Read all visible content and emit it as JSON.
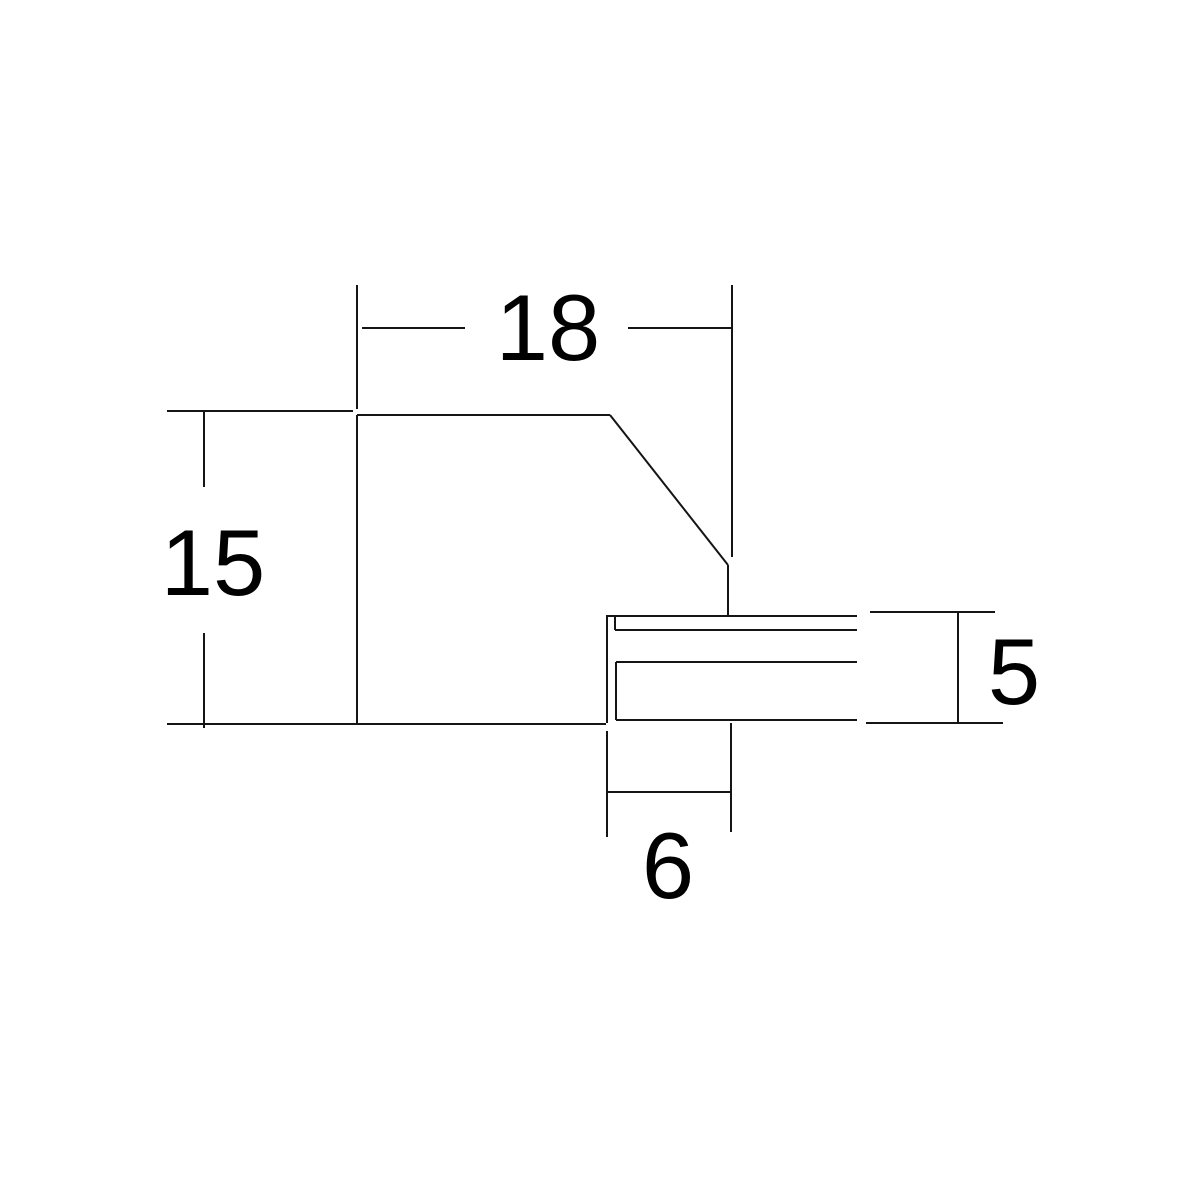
{
  "page": {
    "background": "#ffffff",
    "description": "Technical cross-section profile drawing with four linear dimensions"
  },
  "drawing": {
    "viewbox": "0 0 1200 1200",
    "line_color": "#151515",
    "line_width": 2,
    "label_color": "#000000",
    "label_font_size": 94,
    "labels": [
      {
        "name": "dim-label-18",
        "text": "18",
        "x": 548,
        "y": 360
      },
      {
        "name": "dim-label-15",
        "text": "15",
        "x": 213,
        "y": 595
      },
      {
        "name": "dim-label-5",
        "text": "5",
        "x": 1014,
        "y": 704
      },
      {
        "name": "dim-label-6",
        "text": "6",
        "x": 668,
        "y": 898
      }
    ],
    "segments": [
      {
        "name": "dim18-extension-left",
        "x1": 357,
        "y1": 285,
        "x2": 357,
        "y2": 409
      },
      {
        "name": "dim18-extension-right",
        "x1": 732,
        "y1": 285,
        "x2": 732,
        "y2": 557
      },
      {
        "name": "dim18-line-left",
        "x1": 362,
        "y1": 328,
        "x2": 465,
        "y2": 328
      },
      {
        "name": "dim18-line-right",
        "x1": 628,
        "y1": 328,
        "x2": 732,
        "y2": 328
      },
      {
        "name": "dim15-extension-top",
        "x1": 167,
        "y1": 411,
        "x2": 353,
        "y2": 411
      },
      {
        "name": "dim15-line-upper",
        "x1": 204,
        "y1": 411,
        "x2": 204,
        "y2": 487
      },
      {
        "name": "dim15-line-lower",
        "x1": 204,
        "y1": 633,
        "x2": 204,
        "y2": 728
      },
      {
        "name": "profile-top-edge",
        "x1": 357,
        "y1": 415,
        "x2": 610,
        "y2": 415
      },
      {
        "name": "profile-left-edge",
        "x1": 357,
        "y1": 415,
        "x2": 357,
        "y2": 724
      },
      {
        "name": "profile-chamfer-edge",
        "x1": 610,
        "y1": 415,
        "x2": 728,
        "y2": 565
      },
      {
        "name": "profile-right-edge",
        "x1": 728,
        "y1": 565,
        "x2": 728,
        "y2": 615
      },
      {
        "name": "profile-bottom-edge",
        "x1": 167,
        "y1": 724,
        "x2": 606,
        "y2": 724
      },
      {
        "name": "tab-top-edge",
        "x1": 606,
        "y1": 616,
        "x2": 857,
        "y2": 616
      },
      {
        "name": "tab-left-edge",
        "x1": 607,
        "y1": 616,
        "x2": 607,
        "y2": 723
      },
      {
        "name": "tab-notch-vertical",
        "x1": 615,
        "y1": 616,
        "x2": 615,
        "y2": 630
      },
      {
        "name": "tab-lip-bottom-edge",
        "x1": 615,
        "y1": 630,
        "x2": 857,
        "y2": 630
      },
      {
        "name": "tab-slot-top-edge",
        "x1": 616,
        "y1": 662,
        "x2": 857,
        "y2": 662
      },
      {
        "name": "tab-slot-left-edge",
        "x1": 616,
        "y1": 662,
        "x2": 616,
        "y2": 720
      },
      {
        "name": "tab-slot-bottom-edge",
        "x1": 616,
        "y1": 720,
        "x2": 857,
        "y2": 720
      },
      {
        "name": "dim5-extension-top",
        "x1": 870,
        "y1": 612,
        "x2": 995,
        "y2": 612
      },
      {
        "name": "dim5-extension-bottom",
        "x1": 866,
        "y1": 723,
        "x2": 1003,
        "y2": 723
      },
      {
        "name": "dim5-line",
        "x1": 958,
        "y1": 612,
        "x2": 958,
        "y2": 723
      },
      {
        "name": "dim6-extension-left",
        "x1": 607,
        "y1": 731,
        "x2": 607,
        "y2": 837
      },
      {
        "name": "dim6-extension-right",
        "x1": 731,
        "y1": 723,
        "x2": 731,
        "y2": 832
      },
      {
        "name": "dim6-line",
        "x1": 607,
        "y1": 792,
        "x2": 731,
        "y2": 792
      }
    ]
  }
}
